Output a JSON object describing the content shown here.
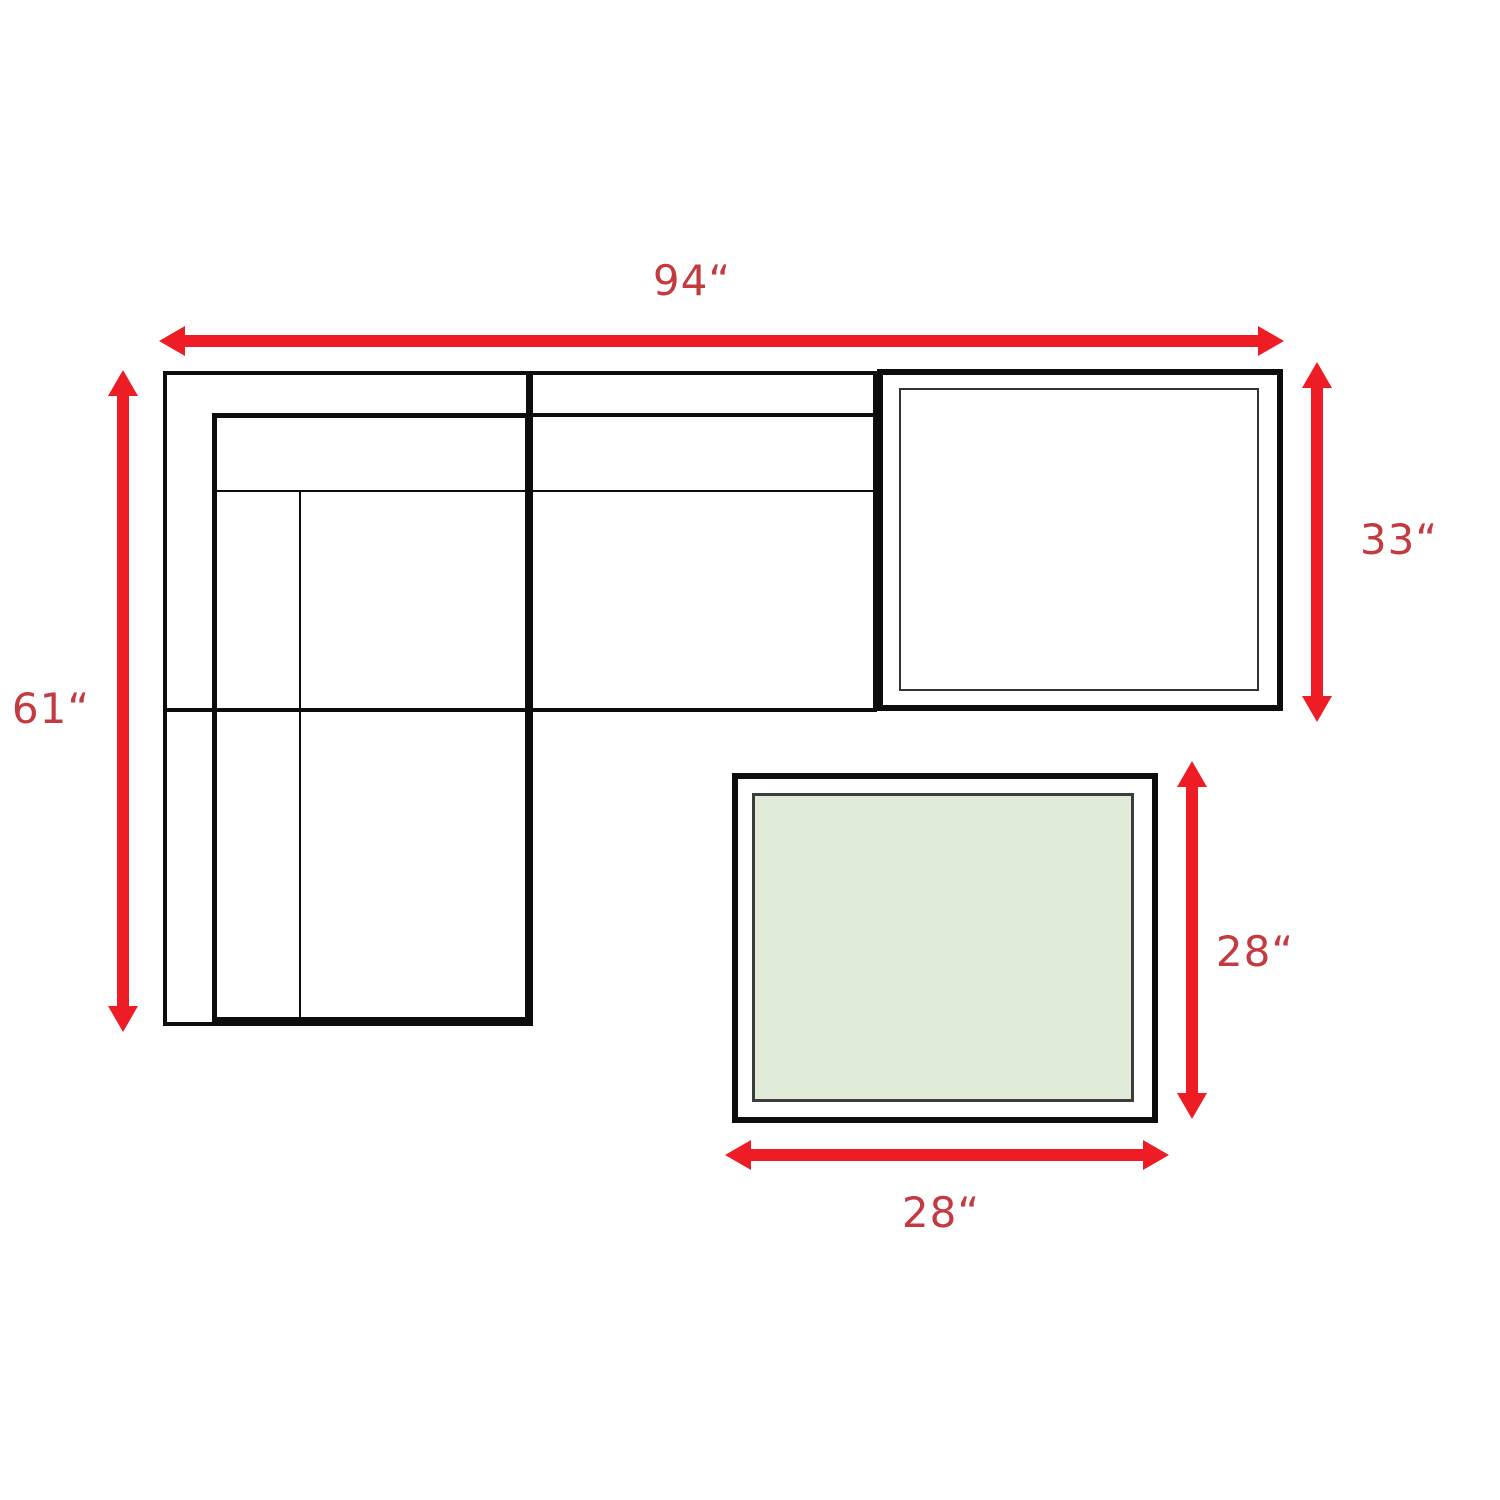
{
  "diagram": {
    "type": "furniture-dimension-diagram",
    "labels": {
      "sofa_width": "94“",
      "sofa_depth": "61“",
      "corner_table_depth": "33“",
      "ottoman_depth": "28“",
      "ottoman_width": "28“"
    },
    "colors": {
      "arrow_red": "#ee1c25",
      "label_red": "#c43a41",
      "outline_black": "#0d0d0d",
      "ottoman_fill": "#e1ecd8"
    }
  }
}
